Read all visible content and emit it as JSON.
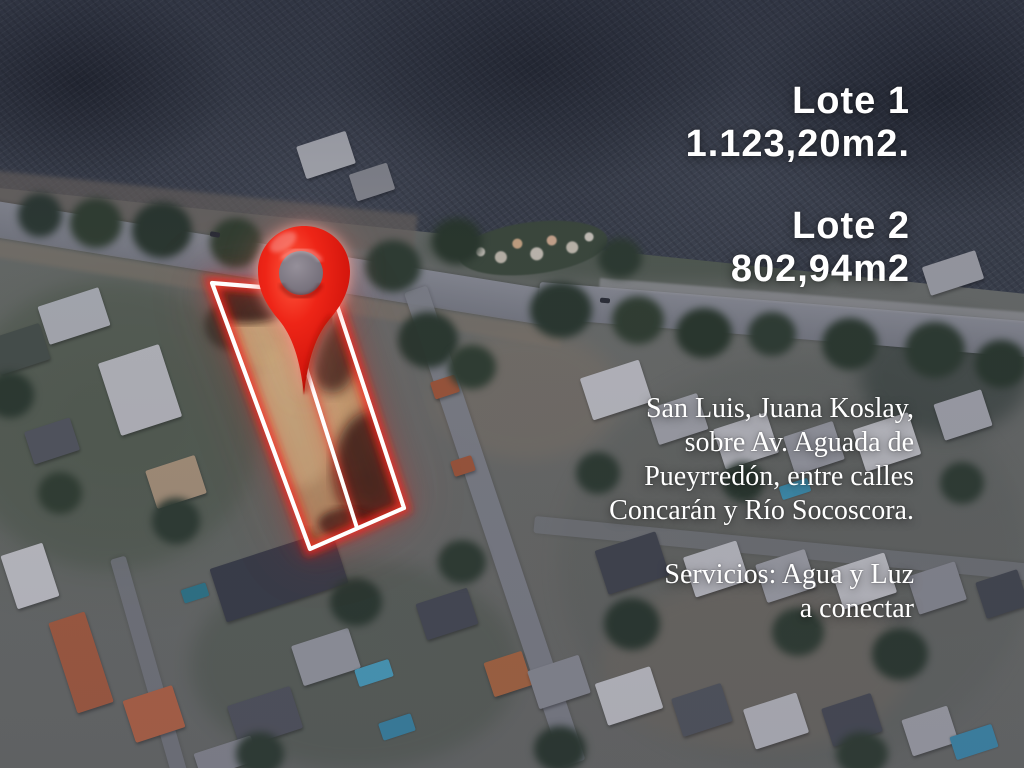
{
  "flyer": {
    "lots": [
      {
        "title": "Lote 1",
        "area": "1.123,20m2."
      },
      {
        "title": "Lote 2",
        "area": "802,94m2"
      }
    ],
    "location": {
      "lines": [
        "San Luis, Juana Koslay,",
        "sobre Av. Aguada de",
        "Pueyrredón, entre calles",
        "Concarán y Río Socoscora."
      ]
    },
    "services": {
      "lines": [
        "Servicios: Agua y Luz",
        "a conectar"
      ]
    },
    "map": {
      "pin_icon": "red-map-pin",
      "colors": {
        "pin_red": "#e31f14",
        "lot_outline": "#ffffff",
        "lot_glow": "#e8231b",
        "lot_ground": "#b3a279",
        "text": "#ffffff"
      }
    }
  }
}
